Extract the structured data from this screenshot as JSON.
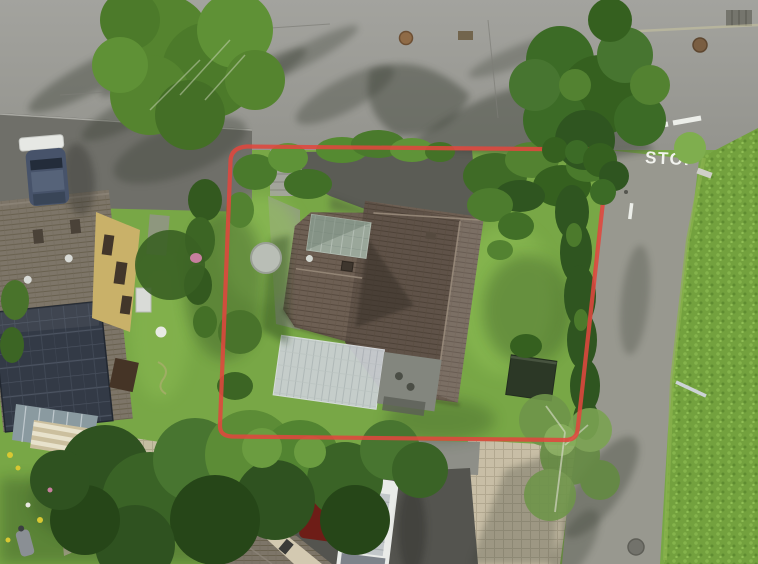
{
  "scene": {
    "type": "aerial-drone-photo",
    "subject": "residential corner plot outlined in red at a street junction",
    "road_marking_text": "STOP",
    "boundary": {
      "color": "#e0473d",
      "corner_style": "rounded",
      "width_px": 4.2
    },
    "palette": {
      "asphalt": "#9b9b96",
      "asphalt_dark": "#6f6f69",
      "shadow": "#3a4036",
      "lawn": "#78a746",
      "field": "#73a13e",
      "tree_dark": "#3c6b26",
      "tree_light": "#5c8c36",
      "main_roof_brown": "#6d5f53",
      "neighbor_roof_grey": "#7d7568",
      "solar_panel": "#333a46",
      "wall_yellow": "#c9b169",
      "pergola_white": "#cbd0d4",
      "paver_tan": "#c8bea6",
      "van_white": "#e9ebe8",
      "car_dark_blue": "#47536a",
      "car_red": "#6e1d17",
      "road_paint_white": "#f2f3ee"
    },
    "objects": {
      "main_house": "hip-roof-house",
      "conservatory": "green-glass-roof",
      "pergola": "white-canopy",
      "garden_shed": "dark-shed",
      "trampoline": "round-grey-trampoline",
      "neighbor_house_west": "house-with-solar-panels",
      "neighbor_house_south": "grey-roof-house",
      "vehicles": [
        "dark-van-north-west",
        "white-van-south",
        "red-car-south"
      ],
      "roads": [
        "street-north",
        "street-east"
      ],
      "field_east": "crop-field",
      "stop_marking": "painted-road-text"
    }
  }
}
